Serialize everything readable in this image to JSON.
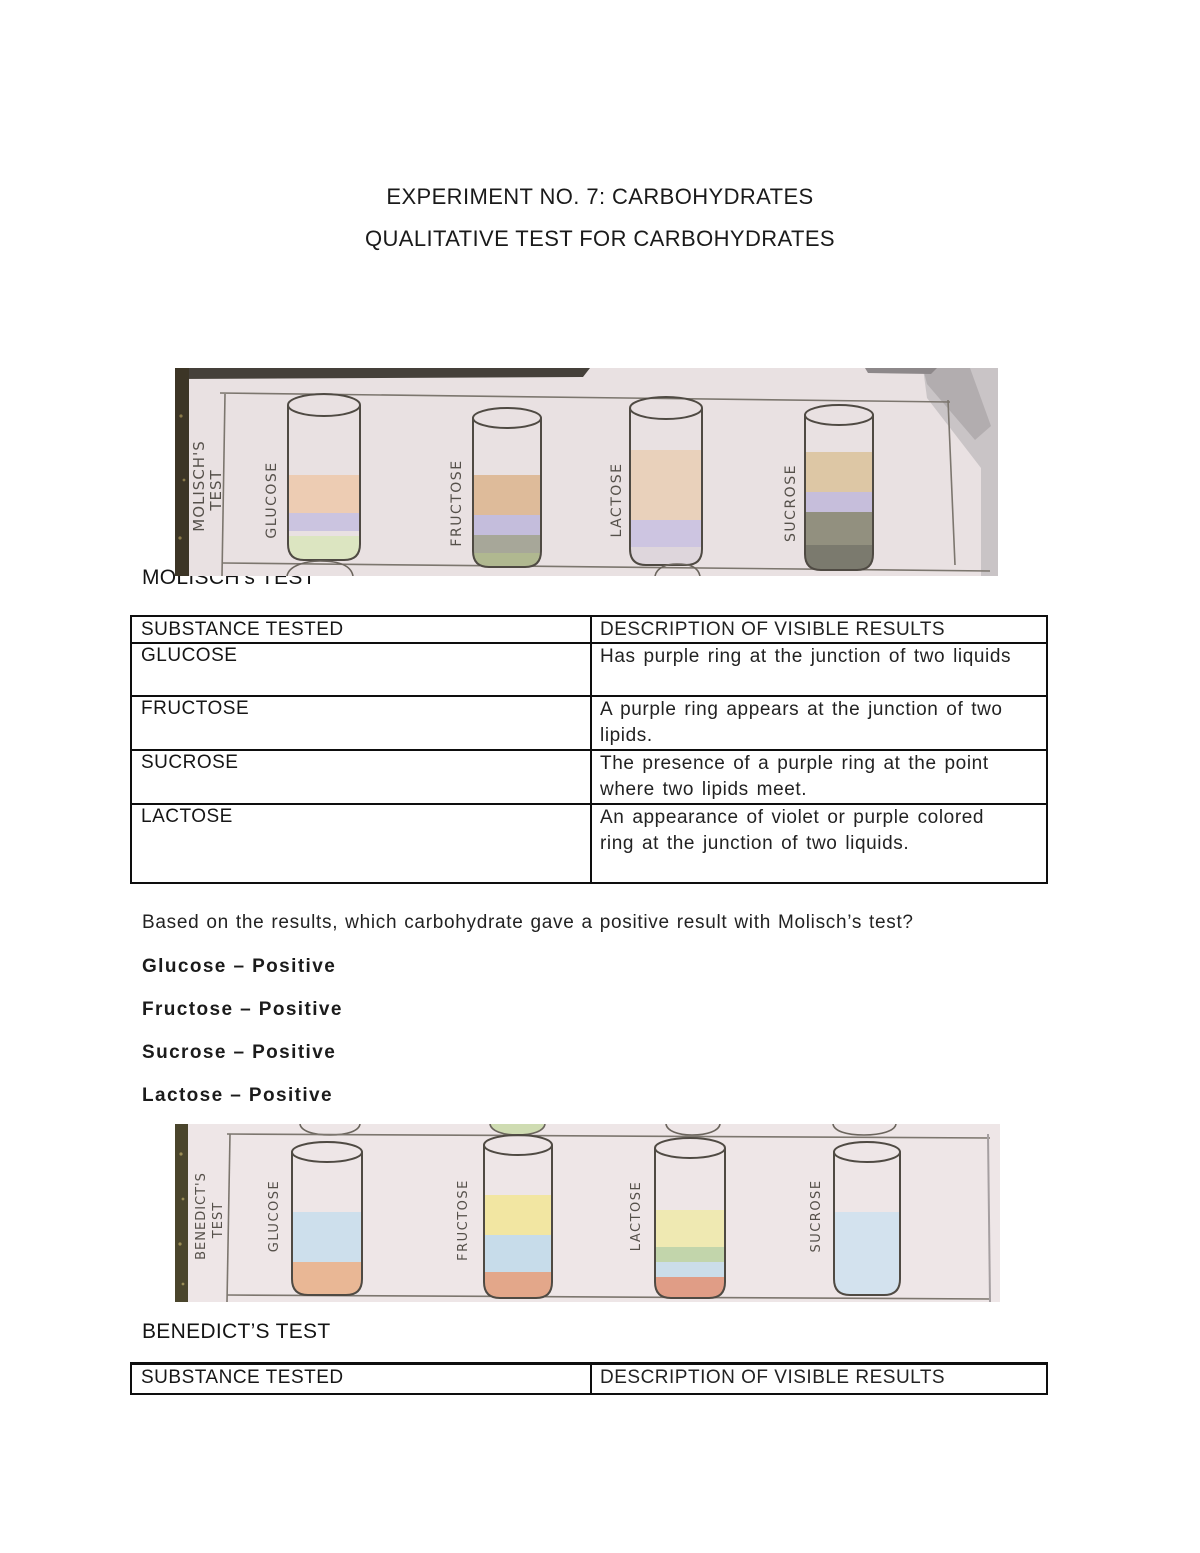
{
  "document": {
    "title_line1": "EXPERIMENT NO. 7: CARBOHYDRATES",
    "title_line2": "QUALITATIVE TEST FOR CARBOHYDRATES"
  },
  "molisch": {
    "heading": "MOLISCH’s TEST",
    "photo": {
      "panel_label_line1": "MOLISCH'S",
      "panel_label_line2": "TEST",
      "paper_color": "#e9e1e2",
      "tubes": [
        {
          "label": "GLUCOSE",
          "layers": [
            "#edccb3",
            "#cbc4e0",
            "#dce5c1"
          ]
        },
        {
          "label": "FRUCTOSE",
          "layers": [
            "#debb9a",
            "#c4bddc",
            "#a7a799",
            "#b0b890"
          ]
        },
        {
          "label": "LACTOSE",
          "layers": [
            "#e9d1bb",
            "#cdc5e1",
            "#ded6dc"
          ]
        },
        {
          "label": "SUCROSE",
          "layers": [
            "#ddc7a5",
            "#c6bedb",
            "#92907f",
            "#7b7a6e"
          ]
        }
      ]
    },
    "table": {
      "headers": [
        "SUBSTANCE TESTED",
        "DESCRIPTION OF VISIBLE RESULTS"
      ],
      "rows": [
        {
          "substance": "GLUCOSE",
          "description": "Has purple ring at the junction of two liquids"
        },
        {
          "substance": "FRUCTOSE",
          "description": "A purple ring appears at the junction of two lipids."
        },
        {
          "substance": "SUCROSE",
          "description": "The presence of a purple ring at the point where two lipids meet."
        },
        {
          "substance": "LACTOSE",
          "description": "An appearance of violet or purple colored ring at the junction of two liquids."
        }
      ]
    },
    "question": "Based on the results, which carbohydrate gave a positive result with Molisch’s test?",
    "answers": [
      "Glucose – Positive",
      "Fructose – Positive",
      "Sucrose – Positive",
      "Lactose – Positive"
    ]
  },
  "benedict": {
    "heading": "BENEDICT’S TEST",
    "photo": {
      "panel_label_line1": "BENEDICT'S",
      "panel_label_line2": "TEST",
      "paper_color": "#eee6e7",
      "tubes": [
        {
          "label": "GLUCOSE",
          "layers": [
            "#cddfec",
            "#e9b795"
          ]
        },
        {
          "label": "FRUCTOSE",
          "layers": [
            "#f2e6a2",
            "#c7dcea",
            "#e3a78a"
          ]
        },
        {
          "label": "LACTOSE",
          "layers": [
            "#efe9b2",
            "#c2d5ab",
            "#cbdde9",
            "#e09d86"
          ]
        },
        {
          "label": "SUCROSE",
          "layers": [
            "#d3e2ee"
          ]
        }
      ]
    },
    "table": {
      "headers": [
        "SUBSTANCE TESTED",
        "DESCRIPTION OF VISIBLE RESULTS"
      ]
    }
  }
}
